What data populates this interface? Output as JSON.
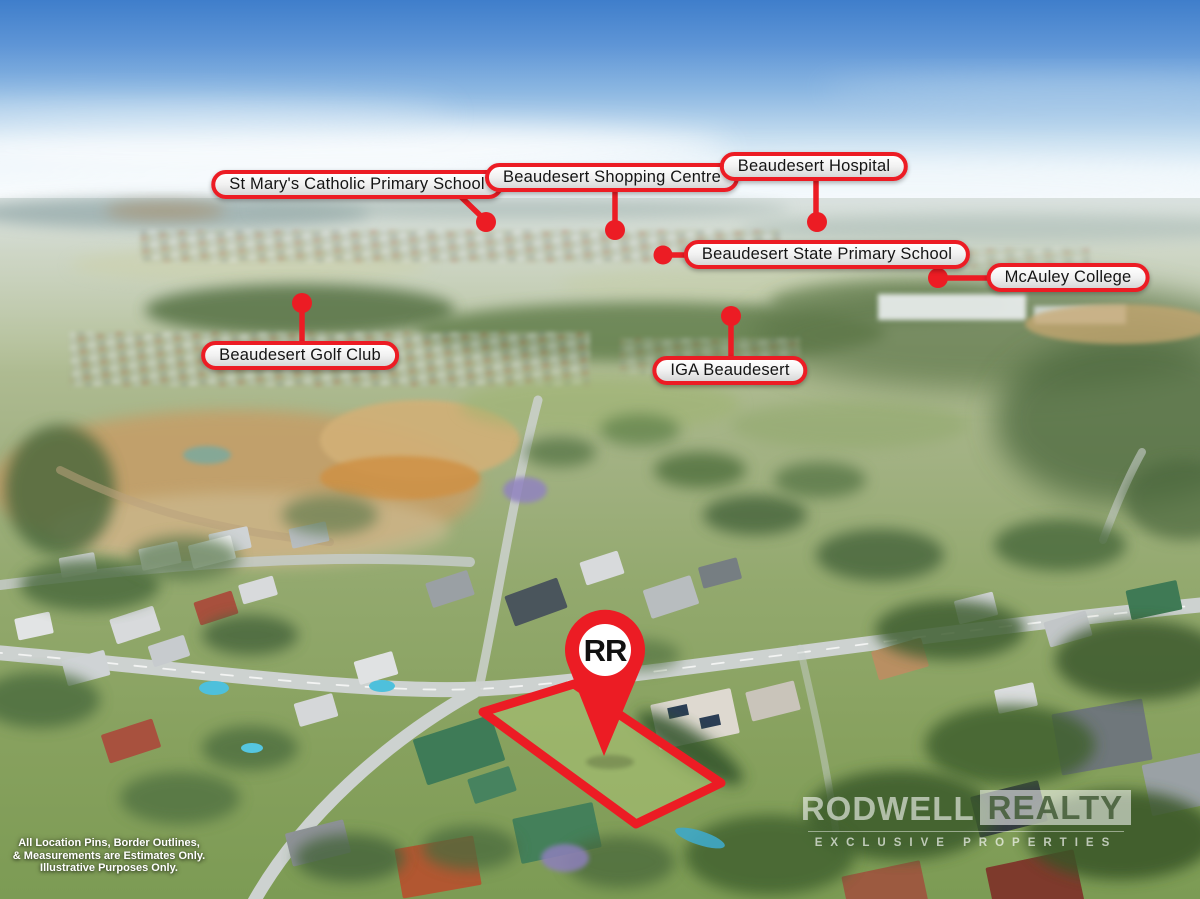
{
  "locations": [
    {
      "label": "St Mary's Catholic Primary School"
    },
    {
      "label": "Beaudesert Shopping Centre"
    },
    {
      "label": "Beaudesert Hospital"
    },
    {
      "label": "Beaudesert State Primary School"
    },
    {
      "label": "McAuley College"
    },
    {
      "label": "Beaudesert Golf Club"
    },
    {
      "label": "IGA Beaudesert"
    }
  ],
  "pin": {
    "label": "RR"
  },
  "watermark": {
    "brand_left": "RODWELL",
    "brand_right": "REALTY",
    "tagline": "EXCLUSIVE PROPERTIES"
  },
  "disclaimer": {
    "lines": [
      "All Location Pins, Border Outlines,",
      "& Measurements are Estimates Only.",
      "Illustrative Purposes Only."
    ]
  },
  "colors": {
    "accent_red": "#ec1c24",
    "pill_background": "#ffffff",
    "pill_text": "#141414",
    "watermark_white": "rgba(255,255,255,0.6)"
  }
}
